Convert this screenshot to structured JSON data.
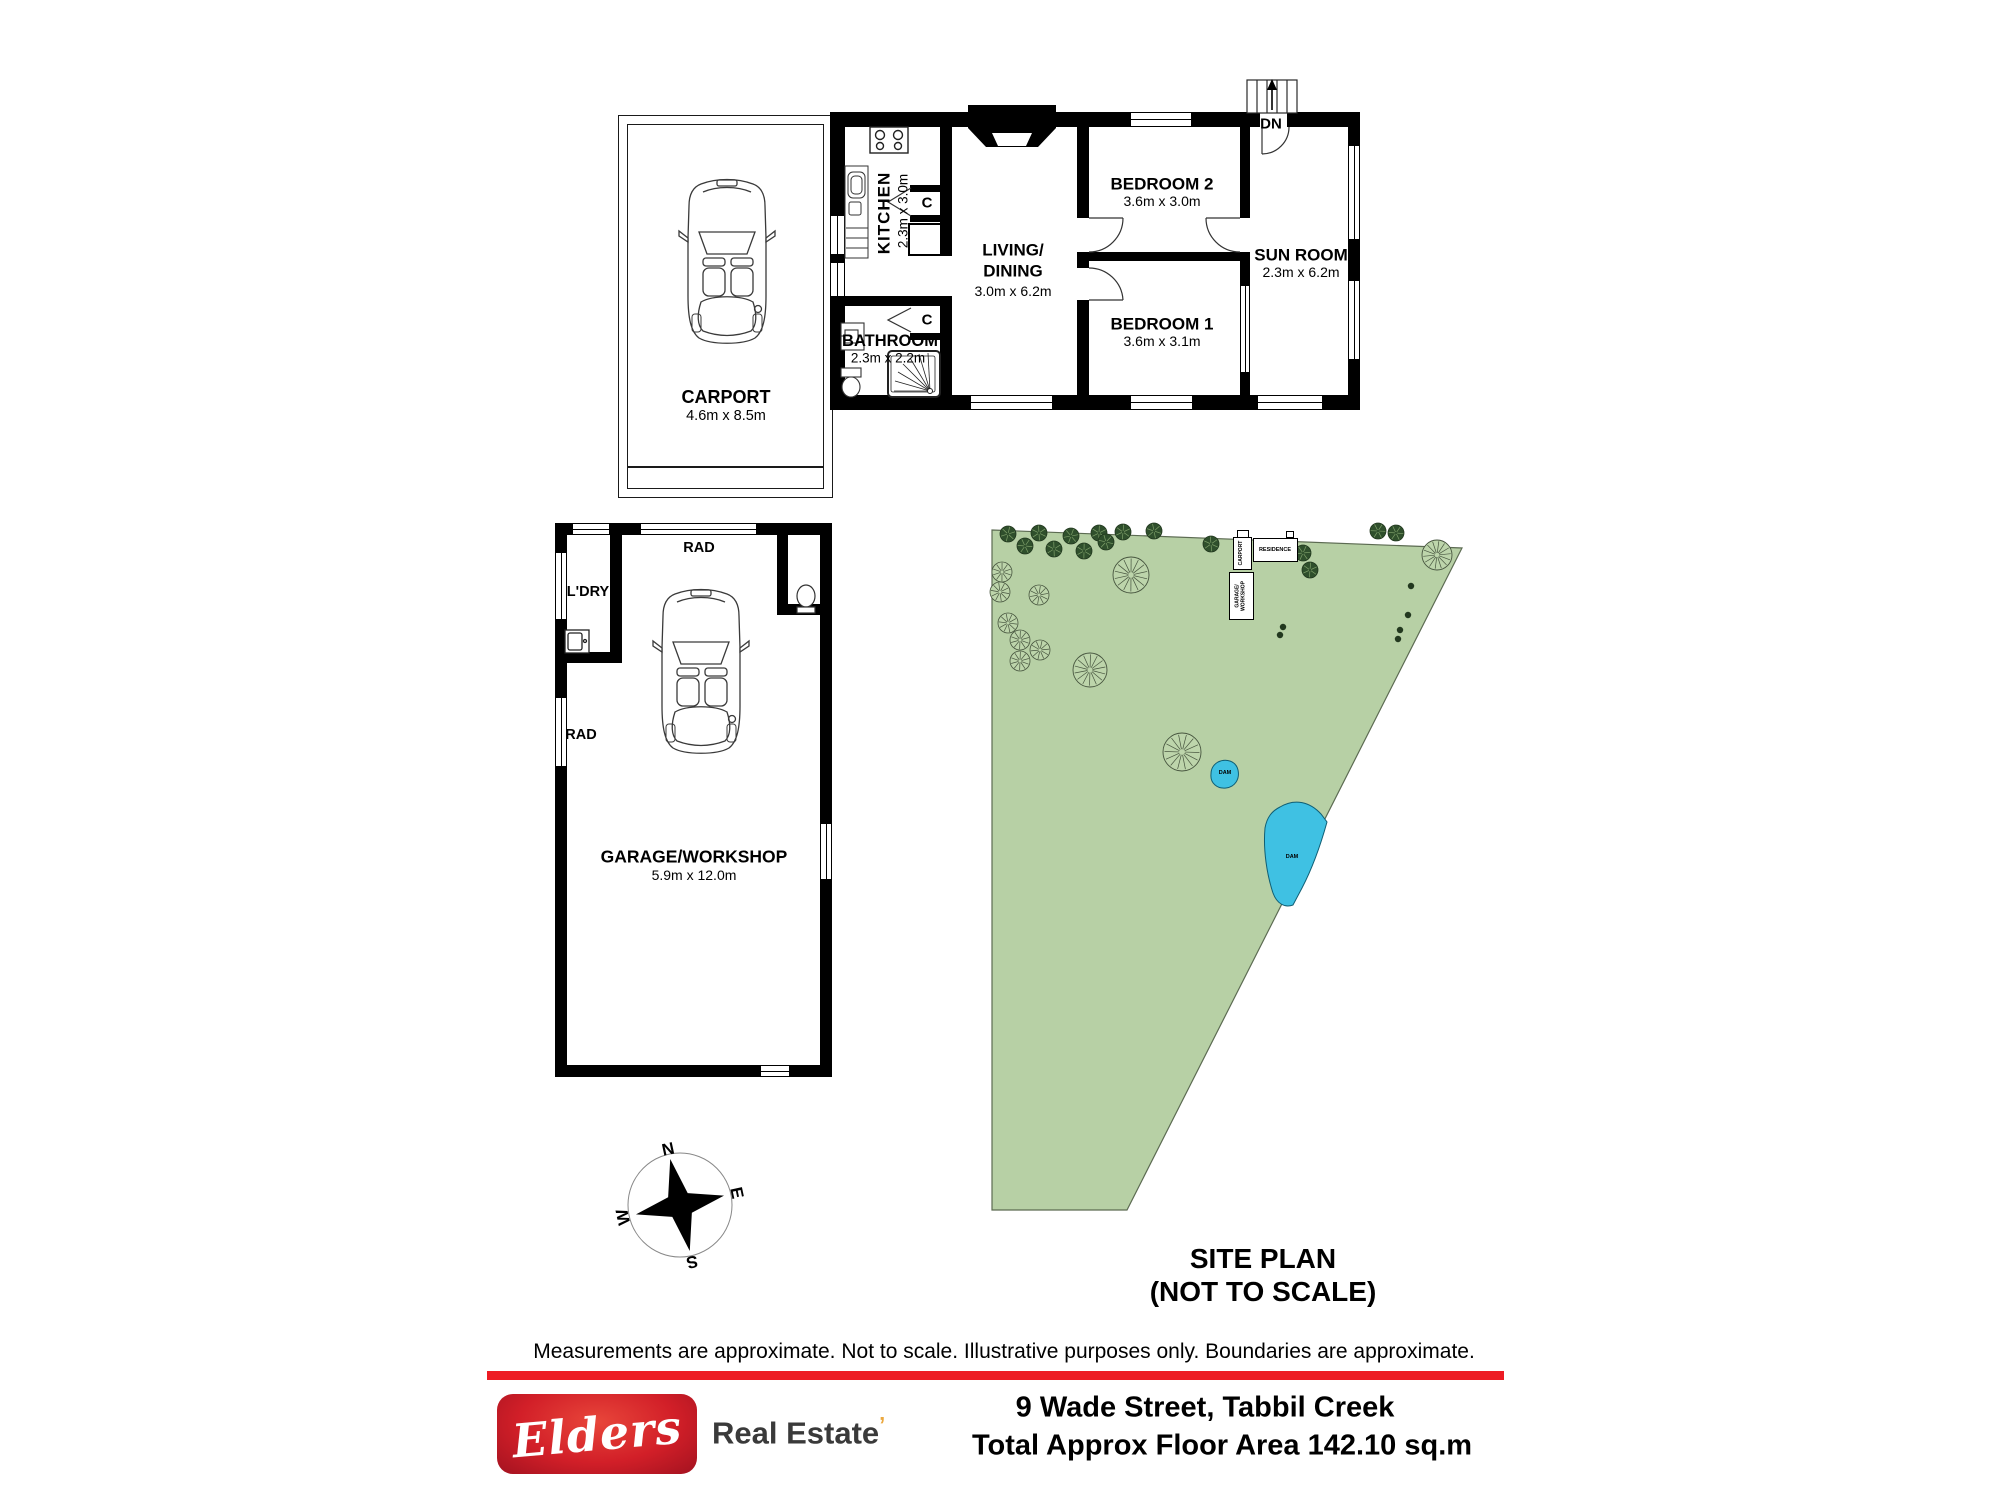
{
  "plan": {
    "carport": {
      "name": "CARPORT",
      "dims": "4.6m x 8.5m"
    },
    "kitchen": {
      "name": "KITCHEN",
      "dims": "2.3m x 3.0m"
    },
    "living": {
      "name1": "LIVING/",
      "name2": "DINING",
      "dims": "3.0m x 6.2m"
    },
    "bathroom": {
      "name": "BATHROOM",
      "dims": "2.3m x 2.2m"
    },
    "bedroom2": {
      "name": "BEDROOM 2",
      "dims": "3.6m x 3.0m"
    },
    "bedroom1": {
      "name": "BEDROOM 1",
      "dims": "3.6m x 3.1m"
    },
    "sunroom": {
      "name": "SUN ROOM",
      "dims": "2.3m x 6.2m"
    },
    "garage": {
      "name": "GARAGE/WORKSHOP",
      "dims": "5.9m x 12.0m"
    },
    "laundry": "L'DRY",
    "rad": "RAD",
    "closet": "C",
    "down": "DN"
  },
  "site": {
    "title": "SITE PLAN",
    "subtitle": "(NOT TO SCALE)",
    "carport_label": "CARPORT",
    "residence_label": "RESIDENCE",
    "garage_label1": "GARAGE/",
    "garage_label2": "WORKSHOP",
    "dam": "DAM",
    "boundary": [
      [
        12,
        10
      ],
      [
        482,
        28
      ],
      [
        147,
        690
      ],
      [
        12,
        690
      ]
    ],
    "trees_small": [
      [
        28,
        14
      ],
      [
        59,
        13
      ],
      [
        91,
        16
      ],
      [
        119,
        13
      ],
      [
        143,
        12
      ],
      [
        174,
        11
      ],
      [
        45,
        26
      ],
      [
        74,
        29
      ],
      [
        104,
        31
      ],
      [
        126,
        22
      ],
      [
        231,
        24
      ],
      [
        323,
        33
      ],
      [
        330,
        50
      ],
      [
        398,
        11
      ],
      [
        416,
        13
      ]
    ],
    "trees_medium": [
      [
        22,
        52
      ],
      [
        20,
        72
      ],
      [
        59,
        75
      ],
      [
        28,
        103
      ],
      [
        40,
        120
      ],
      [
        60,
        130
      ],
      [
        40,
        141
      ]
    ],
    "trees_large": [
      [
        151,
        55,
        18
      ],
      [
        110,
        150,
        17
      ],
      [
        202,
        232,
        19
      ],
      [
        457,
        35,
        15
      ]
    ],
    "dots": [
      [
        303,
        107
      ],
      [
        300,
        115
      ],
      [
        428,
        95
      ],
      [
        420,
        110
      ],
      [
        418,
        119
      ],
      [
        431,
        66
      ]
    ],
    "dam_small_path": "M238,242 C246,238 256,241 258,250 C260,259 255,267 246,268 C237,269 230,263 231,254 C231,249 233,245 238,242 Z",
    "dam_large_path": "M300,287 C315,278 330,282 341,294 L347,302 C342,320 334,345 322,368 L313,385 C305,388 297,384 293,373 C287,355 283,330 285,308 C287,297 292,291 300,287 Z",
    "colors": {
      "ground": "#b7d0a5",
      "boundary_stroke": "#5c6b52",
      "tree_dark": "#2f4f2c",
      "tree_dark_stroke": "#22381f",
      "tree_light_fill": "#bdd5ab",
      "tree_light_stroke": "#46543e",
      "water": "#3fc1e3",
      "water_stroke": "#0f5e74"
    }
  },
  "compass": {
    "n": "N",
    "e": "E",
    "s": "S",
    "w": "W"
  },
  "footer": {
    "disclaimer": "Measurements are approximate. Not to scale. Illustrative purposes only. Boundaries are approximate.",
    "brand": "Elders",
    "brand_suffix": "Real Estate",
    "brand_mark": "’",
    "address": "9 Wade Street, Tabbil Creek",
    "area": "Total Approx Floor Area 142.10 sq.m",
    "bar_color": "#ed1c24",
    "suffix_color": "#3a3a3a",
    "mark_color": "#eba83e"
  }
}
